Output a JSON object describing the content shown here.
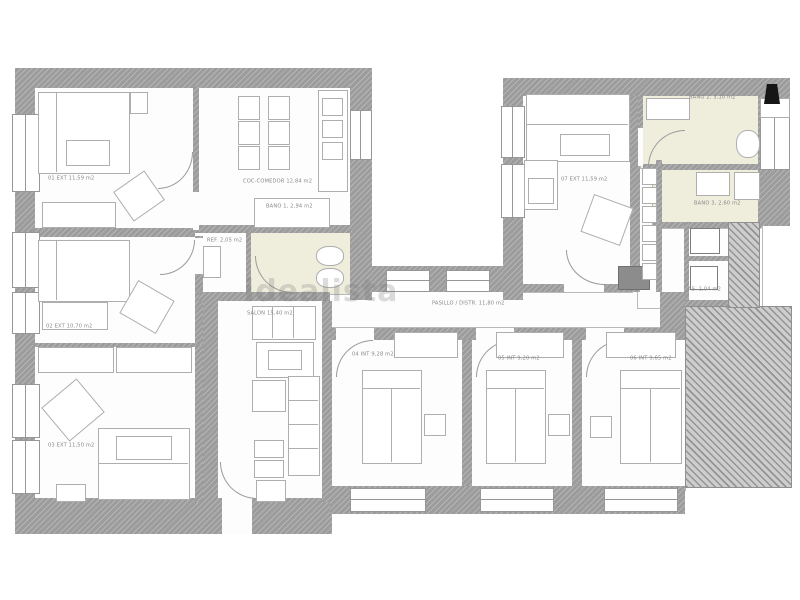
{
  "plan": {
    "watermark": "idealista",
    "rooms": {
      "room01": {
        "label": "01 EXT 11,59 m2"
      },
      "kitchen": {
        "label": "COC-COMEDOR 12,84 m2"
      },
      "bath1": {
        "label": "BAÑO 1, 2,94 m2"
      },
      "ref": {
        "label": "REF. 2,05 m2"
      },
      "room02": {
        "label": "02 EXT 10,70 m2"
      },
      "salon": {
        "label": "SALÓN 15,40 m2"
      },
      "hall": {
        "label": "PASILLO / DISTR. 11,80 m2"
      },
      "room03": {
        "label": "03 EXT 11,50 m2"
      },
      "room04": {
        "label": "04 INT 9,28 m2"
      },
      "room05": {
        "label": "05 INT 9,20 m2"
      },
      "room06": {
        "label": "06 INT 9,65 m2"
      },
      "room07": {
        "label": "07 EXT 11,59 m2"
      },
      "bath2": {
        "label": "BAÑO 2, 3,10 m2"
      },
      "bath3": {
        "label": "BAÑO 3, 2,60 m2"
      },
      "aseo": {
        "label": "AS. 1,04 m2"
      }
    },
    "colors": {
      "wall": "#9c9c9c",
      "bath_floor": "#efeedd",
      "furniture_line": "#aeaeae"
    }
  }
}
